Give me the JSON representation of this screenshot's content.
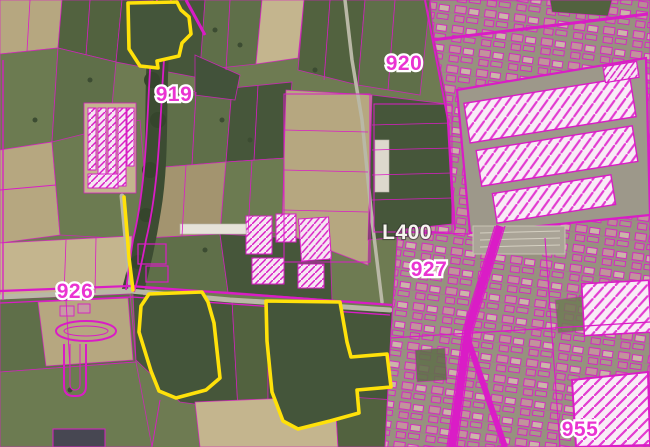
{
  "map": {
    "labels": {
      "l919": "919",
      "l920": "920",
      "l926": "926",
      "l927": "927",
      "l955": "955",
      "l400": "L400"
    },
    "colors": {
      "cadastral_line": "#DA1CC6",
      "highlight": "#FFE10A",
      "zone_label": "#EA34D2",
      "road_label": "#F7F5F0"
    }
  }
}
